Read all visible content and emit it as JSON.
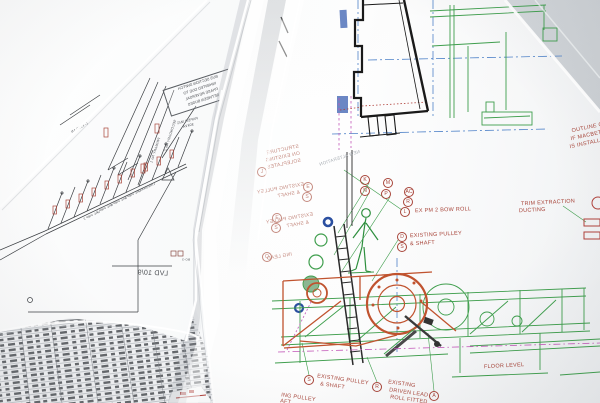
{
  "colors": {
    "label_red": "#a8453a",
    "line_green": "#3f9e4d",
    "line_blue": "#4f82c8",
    "line_orange": "#c0532f",
    "line_magenta": "#c257b8",
    "ink": "#4a4d52"
  },
  "main_sheet": {
    "callouts": [
      {
        "t": "K",
        "x": 365,
        "y": 180
      },
      {
        "t": "N",
        "x": 365,
        "y": 191
      },
      {
        "t": "M",
        "x": 388,
        "y": 183
      },
      {
        "t": "P",
        "x": 386,
        "y": 194
      },
      {
        "t": "AC",
        "x": 409,
        "y": 192
      },
      {
        "t": "R",
        "x": 408,
        "y": 202
      },
      {
        "t": "L",
        "x": 405,
        "y": 212
      },
      {
        "t": "D",
        "x": 402,
        "y": 237
      },
      {
        "t": "S",
        "x": 402,
        "y": 247
      },
      {
        "t": "S",
        "x": 309,
        "y": 380
      },
      {
        "t": "R",
        "x": 377,
        "y": 387
      },
      {
        "t": "A",
        "x": 434,
        "y": 396
      }
    ],
    "mirrored_callouts": [
      {
        "t": "J",
        "x": 262,
        "y": 172,
        "m": 1
      },
      {
        "t": "E",
        "x": 308,
        "y": 187,
        "m": 1
      },
      {
        "t": "S",
        "x": 307,
        "y": 197,
        "m": 1
      },
      {
        "t": "E",
        "x": 277,
        "y": 218,
        "m": 1
      },
      {
        "t": "S",
        "x": 276,
        "y": 228,
        "m": 1
      },
      {
        "t": "Q",
        "x": 267,
        "y": 257,
        "m": 1
      }
    ],
    "labels": [
      {
        "t": "EX PM 2 BOW ROLL",
        "x": 415,
        "y": 212,
        "r": -2
      },
      {
        "t": "EXISTING PULLEY",
        "x": 410,
        "y": 237,
        "r": -3
      },
      {
        "t": "& SHAFT",
        "x": 410,
        "y": 245,
        "r": -3
      },
      {
        "t": "TRIM EXTRACTION",
        "x": 521,
        "y": 205,
        "r": -3
      },
      {
        "t": "DUCTING",
        "x": 519,
        "y": 212,
        "r": -3
      },
      {
        "t": "OUTLINE OF",
        "x": 572,
        "y": 132,
        "r": -12
      },
      {
        "t": "IF MACBETH",
        "x": 571,
        "y": 140,
        "r": -12
      },
      {
        "t": "IS INSTALLED",
        "x": 570,
        "y": 148,
        "r": -12
      },
      {
        "t": "FLOOR LEVEL",
        "x": 484,
        "y": 368,
        "r": -3
      },
      {
        "t": "EXISTING PULLEY",
        "x": 317,
        "y": 377,
        "r": 8
      },
      {
        "t": "& SHAFT",
        "x": 320,
        "y": 385,
        "r": 8
      },
      {
        "t": "EXISTING",
        "x": 388,
        "y": 383,
        "r": 8
      },
      {
        "t": "DRIVEN LEAD",
        "x": 389,
        "y": 391,
        "r": 8
      },
      {
        "t": "ROLL FITTED",
        "x": 390,
        "y": 398,
        "r": 8
      },
      {
        "t": "ING PULLEY",
        "x": 281,
        "y": 396,
        "r": 8
      },
      {
        "t": "AFT",
        "x": 280,
        "y": 402,
        "r": 8
      }
    ],
    "mirrored_labels": [
      {
        "t": "STRUCTURE",
        "x": 299,
        "y": 147,
        "r": -12,
        "m": 1,
        "c": "faded-red",
        "s": 5
      },
      {
        "t": "ON EXISTING",
        "x": 300,
        "y": 154,
        "r": -12,
        "m": 1,
        "c": "faded-red",
        "s": 5
      },
      {
        "t": "SOLEPLATES",
        "x": 301,
        "y": 161,
        "r": -12,
        "m": 1,
        "c": "faded-red",
        "s": 5
      },
      {
        "t": "EXISTING PULLEY",
        "x": 304,
        "y": 185,
        "r": -10,
        "m": 1,
        "c": "faded-red",
        "s": 5
      },
      {
        "t": "& SHAFT",
        "x": 300,
        "y": 193,
        "r": -10,
        "m": 1,
        "c": "faded-red",
        "s": 5
      },
      {
        "t": "EXISTING PULLEY",
        "x": 313,
        "y": 215,
        "r": -10,
        "m": 1,
        "c": "faded-red",
        "s": 5
      },
      {
        "t": "& SHAFT",
        "x": 309,
        "y": 223,
        "r": -10,
        "m": 1,
        "c": "faded-red",
        "s": 5
      },
      {
        "t": "ING LEAD",
        "x": 292,
        "y": 255,
        "r": -10,
        "m": 1,
        "c": "faded-red",
        "s": 5
      },
      {
        "t": "NEW ALTERATION",
        "x": 360,
        "y": 152,
        "r": -18,
        "m": 1,
        "c": "pencil",
        "s": 4.5
      }
    ]
  },
  "left_sheet": {
    "note_box_lines": [
      "BUS SECTION SWITCH",
      "INHIBITED DUE TO",
      "PHASE REVERSAL",
      "BETWEEN BUSES"
    ],
    "texts": [
      {
        "t": "LVD 10/9",
        "x": 168,
        "y": 274,
        "r": 2,
        "m": 1,
        "c": "ink",
        "s": 7
      },
      {
        "t": "PAPER M/C",
        "x": 198,
        "y": 119,
        "r": -14,
        "m": 1,
        "c": "ink",
        "s": 3.6
      },
      {
        "t": "30kVA",
        "x": 194,
        "y": 125,
        "r": -14,
        "m": 1,
        "c": "ink",
        "s": 3.6
      },
      {
        "t": "SECONDARY No 2",
        "x": 176,
        "y": 120,
        "r": -72,
        "m": 1,
        "c": "ink",
        "s": 3.4
      },
      {
        "t": "PRIMARY No 1",
        "x": 160,
        "y": 138,
        "r": -72,
        "m": 1,
        "c": "ink",
        "s": 3.4
      },
      {
        "t": "L-V910-1N",
        "x": 88,
        "y": 124,
        "r": -28,
        "m": 1,
        "c": "ink",
        "s": 3.4
      },
      {
        "t": "VAC PMP 2",
        "x": 100,
        "y": 212,
        "r": -25,
        "m": 1,
        "c": "ink",
        "s": 3
      },
      {
        "t": "VAC PMP 3",
        "x": 113,
        "y": 205,
        "r": -25,
        "m": 1,
        "c": "ink",
        "s": 3
      },
      {
        "t": "VAC PMP 4",
        "x": 127,
        "y": 198,
        "r": -25,
        "m": 1,
        "c": "ink",
        "s": 3
      },
      {
        "t": "VAC PMP 5",
        "x": 141,
        "y": 191,
        "r": -25,
        "m": 1,
        "c": "ink",
        "s": 3
      },
      {
        "t": "LINESHAFT",
        "x": 155,
        "y": 184,
        "r": -25,
        "m": 1,
        "c": "ink",
        "s": 3
      },
      {
        "t": "BO-3",
        "x": 190,
        "y": 260,
        "r": 0,
        "m": 1,
        "c": "ink",
        "s": 3
      }
    ]
  }
}
